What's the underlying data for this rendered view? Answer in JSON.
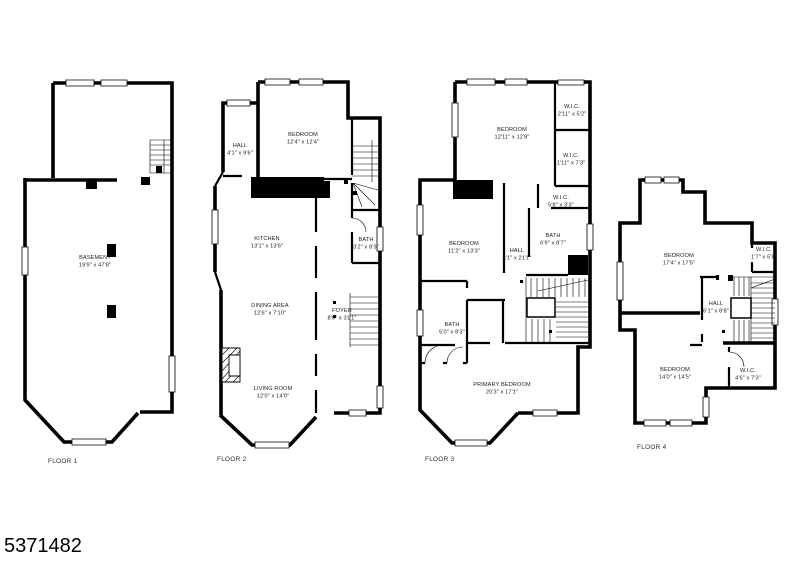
{
  "page": {
    "id_number": "5371482",
    "background": "#ffffff",
    "line_color": "#000000"
  },
  "floors": [
    {
      "label": "FLOOR 1",
      "rooms": [
        {
          "name": "BASEMENT",
          "dims": "19'9\" x 47'8\""
        }
      ]
    },
    {
      "label": "FLOOR 2",
      "rooms": [
        {
          "name": "BEDROOM",
          "dims": "12'4\" x 12'4\""
        },
        {
          "name": "HALL",
          "dims": "4'1\" x 9'6\""
        },
        {
          "name": "KITCHEN",
          "dims": "13'1\" x 13'6\""
        },
        {
          "name": "BATH",
          "dims": "3'2\" x 8'3\""
        },
        {
          "name": "DINING AREA",
          "dims": "12'6\" x 7'10\""
        },
        {
          "name": "FOYER",
          "dims": "8'0\" x 31'1\""
        },
        {
          "name": "LIVING ROOM",
          "dims": "12'0\" x 14'0\""
        }
      ]
    },
    {
      "label": "FLOOR 3",
      "rooms": [
        {
          "name": "BEDROOM",
          "dims": "12'11\" x 12'8\""
        },
        {
          "name": "W.I.C.",
          "dims": "2'11\" x 5'2\""
        },
        {
          "name": "W.I.C.",
          "dims": "1'11\" x 7'3\""
        },
        {
          "name": "BEDROOM",
          "dims": "11'2\" x 13'3\""
        },
        {
          "name": "HALL",
          "dims": "6'1\" x 21'1\""
        },
        {
          "name": "W.I.C.",
          "dims": "5'8\" x 3'3\""
        },
        {
          "name": "BATH",
          "dims": "6'9\" x 8'7\""
        },
        {
          "name": "BATH",
          "dims": "5'0\" x 8'3\""
        },
        {
          "name": "PRIMARY BEDROOM",
          "dims": "20'3\" x 17'1\""
        }
      ]
    },
    {
      "label": "FLOOR 4",
      "rooms": [
        {
          "name": "BEDROOM",
          "dims": "17'4\" x 17'5\""
        },
        {
          "name": "W.I.C.",
          "dims": "1'7\" x 6'8\""
        },
        {
          "name": "HALL",
          "dims": "6'1\" x 8'8\""
        },
        {
          "name": "BEDROOM",
          "dims": "14'0\" x 14'5\""
        },
        {
          "name": "W.I.C.",
          "dims": "4'6\" x 7'3\""
        }
      ]
    }
  ]
}
